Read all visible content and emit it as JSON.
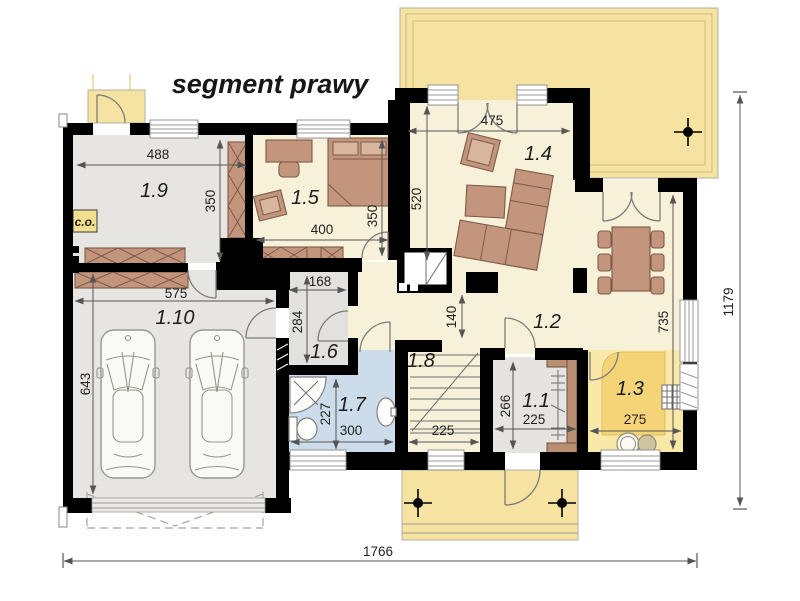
{
  "title": "segment prawy",
  "rooms": {
    "r1_1": "1.1",
    "r1_2": "1.2",
    "r1_3": "1.3",
    "r1_4": "1.4",
    "r1_5": "1.5",
    "r1_6": "1.6",
    "r1_7": "1.7",
    "r1_8": "1.8",
    "r1_9": "1.9",
    "r1_10": "1.10"
  },
  "labels": {
    "central_heating": "c.o."
  },
  "dims": {
    "room19_width": "488",
    "room19_depth": "350",
    "room15_width": "400",
    "room15_depth": "350",
    "room14_width": "475",
    "room14_depth": "520",
    "hall16_width": "168",
    "hall16_depth": "284",
    "garage_width": "575",
    "garage_depth": "643",
    "passage_width": "140",
    "bath17_depth": "227",
    "bath17_width": "300",
    "stairs18_width": "225",
    "hall11_depth": "266",
    "hall11_width": "225",
    "kitchen13_width": "275",
    "zone12_depth": "735",
    "total_width": "1766",
    "total_depth": "1179"
  },
  "colors": {
    "wall": "#000000",
    "floor_gray": "#e7e5e2",
    "floor_cream": "#f7f1da",
    "floor_blue": "#cddcea",
    "floor_yellow": "#f9e8a8",
    "counter_yellow": "#f5d478",
    "terrace": "#f6e3a1",
    "furniture": "#c2957c"
  }
}
